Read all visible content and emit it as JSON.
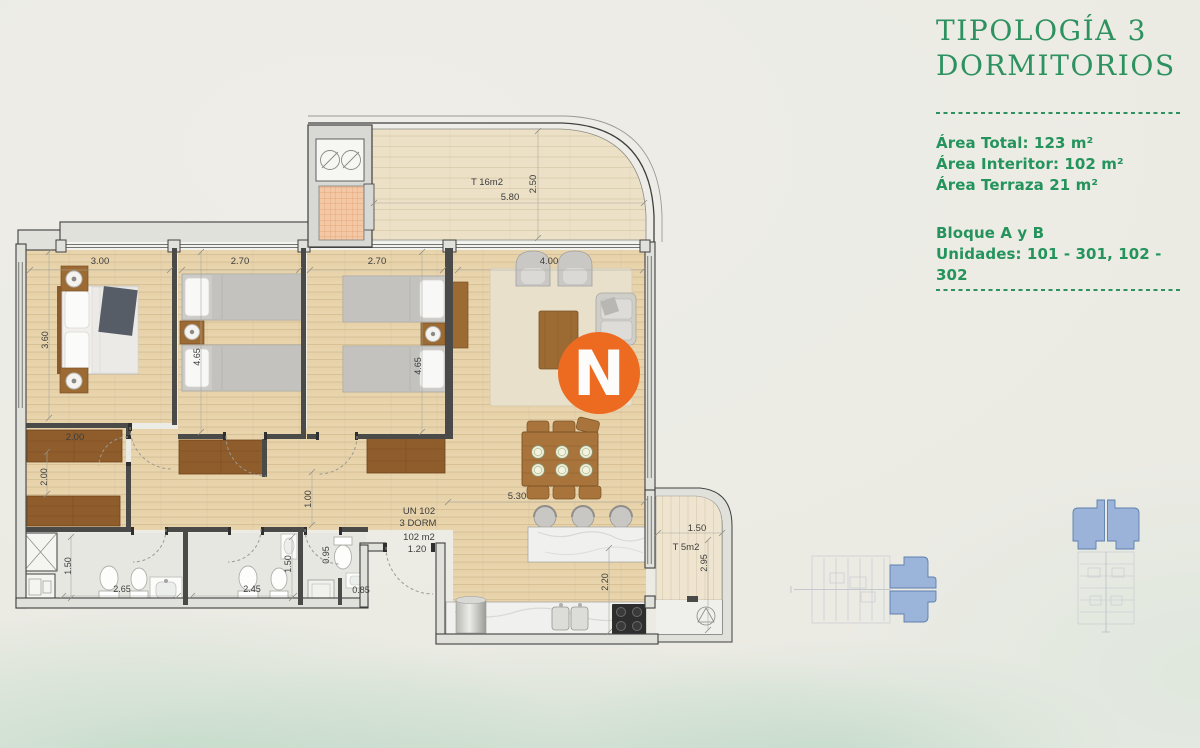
{
  "header": {
    "title_line1": "TIPOLOGÍA 3",
    "title_line2": "DORMITORIOS"
  },
  "details": {
    "area_total": "Área Total: 123 m²",
    "area_interior": "Área Interitor: 102 m²",
    "area_terraza": "Área Terraza 21 m²",
    "bloque": "Bloque A y B",
    "unidades": "Unidades: 101 - 301, 102 - 302"
  },
  "logo": {
    "letter": "N",
    "color": "#ed6a21"
  },
  "colors": {
    "accent_green": "#2e9160",
    "highlight_blue": "#8aa7d7"
  },
  "plan": {
    "terrace_top": {
      "label": "T 16m2",
      "width": "5.80",
      "depth": "2.50"
    },
    "master": {
      "width": "3.00",
      "depth": "3.60"
    },
    "bedroom2": {
      "width": "2.70",
      "depth": "4.65"
    },
    "bedroom3": {
      "width": "2.70",
      "depth": "4.65"
    },
    "living": {
      "width": "4.00"
    },
    "closet": {
      "width": "2.00",
      "depth": "2.00"
    },
    "hall": {
      "width": "1.00"
    },
    "unit": {
      "l1": "UN 102",
      "l2": "3 DORM",
      "l3": "102 m2",
      "l4": "1.20"
    },
    "kitchen": {
      "width": "5.30",
      "depth": "2.20"
    },
    "bath1": {
      "depth": "1.50",
      "width": "2.65"
    },
    "bath2": {
      "depth": "1.50",
      "width": "2.45"
    },
    "bath3": {
      "depth": "0.95",
      "width": "0.85"
    },
    "terrace_side": {
      "label": "T 5m2",
      "width": "1.50",
      "depth": "2.95"
    }
  }
}
